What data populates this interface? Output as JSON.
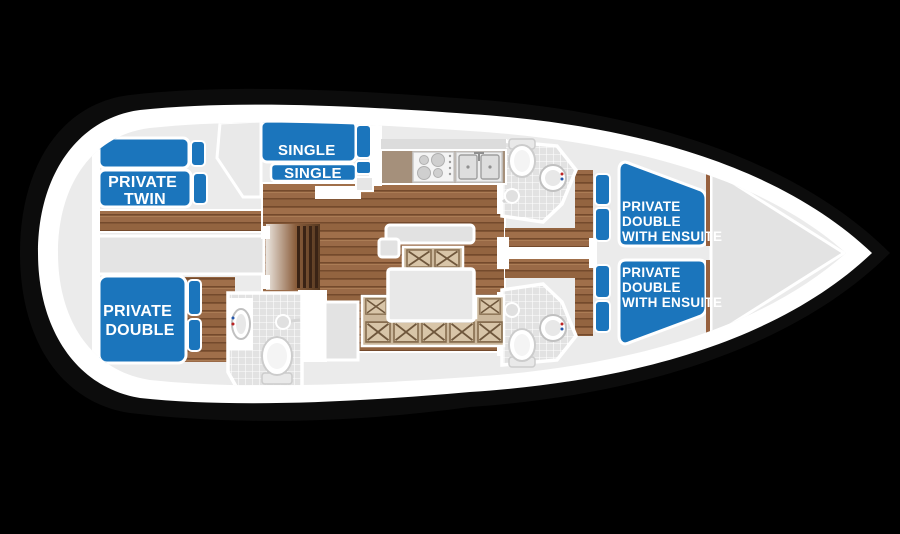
{
  "page": {
    "background": "#000000",
    "description": "Sailing yacht interior accommodation floor plan, bow pointing right"
  },
  "boat": {
    "hull_band_color": "#ffffff",
    "interior_color": "#ebebeb",
    "accent_blue": "#1b75bc",
    "wood_color": "#9a6a47",
    "bench_tan": "#ccb89c"
  },
  "cabins": [
    {
      "id": "aft-top-twin",
      "label_lines": [
        "PRIVATE",
        "TWIN"
      ]
    },
    {
      "id": "mid-top-singles",
      "label_lines": [
        "SINGLE",
        "SINGLE"
      ]
    },
    {
      "id": "aft-bottom-double",
      "label_lines": [
        "PRIVATE",
        "DOUBLE"
      ]
    },
    {
      "id": "forward-top-double-ensuite",
      "label_lines": [
        "PRIVATE",
        "DOUBLE",
        "WITH ENSUITE"
      ]
    },
    {
      "id": "forward-bottom-double-ensuite",
      "label_lines": [
        "PRIVATE",
        "DOUBLE",
        "WITH ENSUITE"
      ]
    }
  ],
  "fixtures": [
    "toilet",
    "washbasin",
    "shower",
    "stove-4-burner",
    "double-sink",
    "saloon-table",
    "x-pattern-bench-seating",
    "companionway-steps",
    "anchor-locker",
    "bed",
    "pillow"
  ]
}
